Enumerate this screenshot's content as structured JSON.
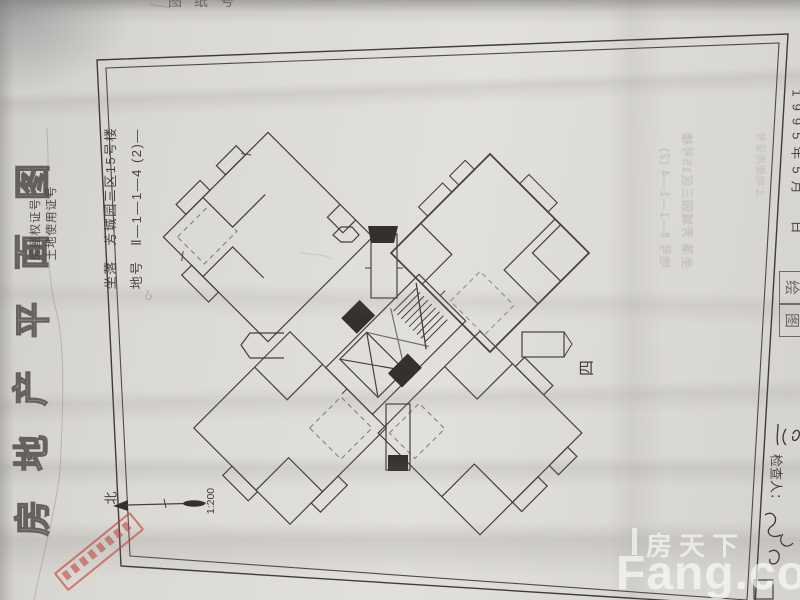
{
  "document": {
    "top_edge_label": "图纸号",
    "side_title": "房地产平面图",
    "side_title_chars": [
      "图",
      "面",
      "平",
      "产",
      "地",
      "房"
    ],
    "cert_no_label": "房屋权证号",
    "land_cert_label": "土地使用证号",
    "location_line": "坐落　芳城园三区15号楼",
    "plot_line": "地号　Ⅱ—1—1—4 (2)—",
    "floor_label": "四",
    "north_label": "北",
    "scale_label": "1:200",
    "date_label": "1995年5月　日",
    "inspector_label": "检查人：",
    "drawer_box_chars": [
      "绘",
      "图"
    ],
    "bleedthrough_line1": "坐落 芳城园三区15号楼",
    "bleedthrough_line2": "地号 Ⅱ—1—1—4 (2)",
    "bleedthrough_line3": "土地使用证号"
  },
  "watermark": {
    "cn": "房天下",
    "en": "Fang.com"
  },
  "colors": {
    "ink": "#44413c",
    "red_stamp": "#c6423a",
    "paper": "#dbd9d4"
  }
}
